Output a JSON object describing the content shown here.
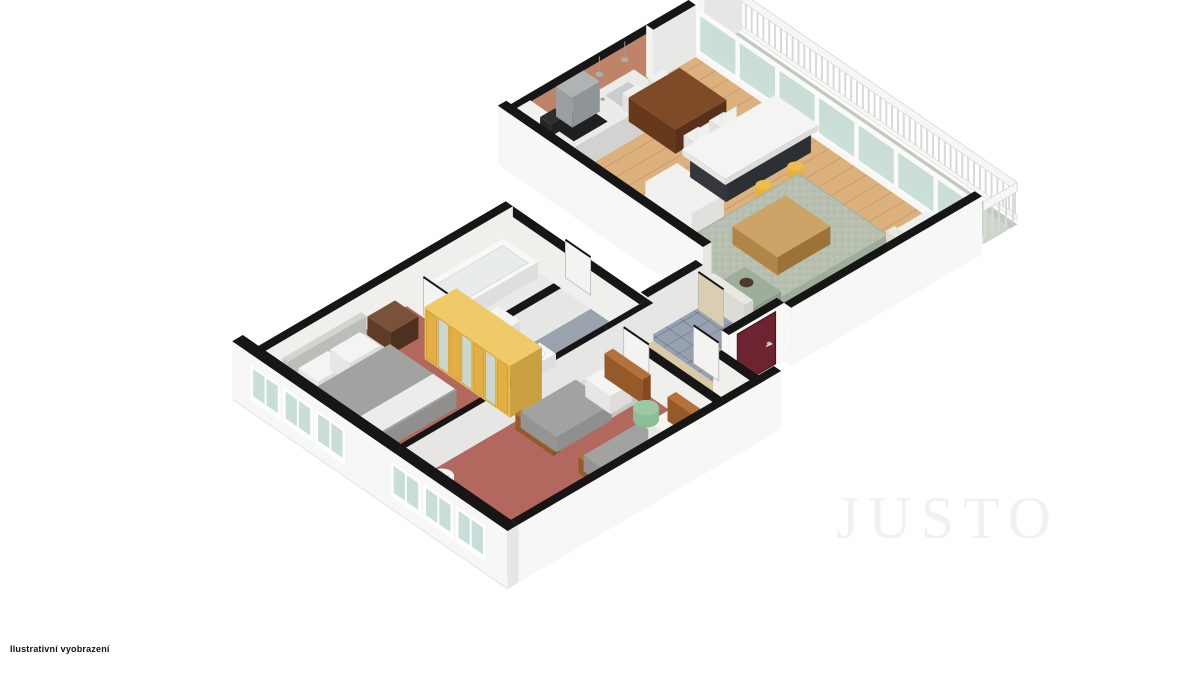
{
  "page": {
    "background": "#ffffff",
    "width": 1200,
    "height": 675
  },
  "watermark": {
    "text": "JUSTO",
    "color": "#f1f1f1"
  },
  "disclaimer": {
    "text": "Ilustrativní vyobrazení",
    "color": "#141414"
  },
  "plan": {
    "type": "3d-floorplan",
    "style": "isometric dollhouse cutaway, white background, black wall caps",
    "rooms": [
      {
        "id": "bedroom-main",
        "floor": "#b2685e"
      },
      {
        "id": "bedroom-second",
        "floor": "#b2685e"
      },
      {
        "id": "bathroom",
        "floor": "#e9e9e6"
      },
      {
        "id": "wc",
        "floor": "#9aa2ad"
      },
      {
        "id": "hallway",
        "floor": "#d9c9a8"
      },
      {
        "id": "entry-hall",
        "floor": "#98a1b0"
      },
      {
        "id": "kitchen",
        "floor": "#ddb17e"
      },
      {
        "id": "living-room",
        "floor": "#ddb17e"
      },
      {
        "id": "balcony",
        "floor": "#cdd4c9"
      }
    ],
    "furniture": [
      "double-bed",
      "nightstand",
      "wardrobe",
      "single-bed",
      "single-bed",
      "pouf",
      "bedside-lamp-table",
      "bathtub",
      "washbasin",
      "toilet",
      "kitchen-counter",
      "range-hood",
      "tall-cabinet",
      "hall-closet",
      "kitchen-island",
      "bar-stool",
      "bar-stool",
      "dining-table",
      "dining-chair",
      "dining-chair",
      "dining-chair",
      "dining-chair",
      "sofa",
      "armchair",
      "chaise-lounge",
      "coffee-table",
      "area-rug",
      "entrance-door",
      "interior-doors",
      "balcony-railing"
    ],
    "colors": {
      "wallCap": "#161616",
      "wallFaceFront": "#f7f7f5",
      "wallFaceSide": "#e6e6e4",
      "wallFaceInner": "#efefec",
      "wood": "#ddb17e",
      "woodLine": "rgba(150,105,55,0.28)",
      "carpet": "#b2685e",
      "carpetEdge": "#a05a50",
      "tile": "#98a1b0",
      "tileLine": "rgba(60,70,95,0.35)",
      "bathFloor": "#e9e9e6",
      "wcFloor": "#9aa2ad",
      "hallFloor": "#d9c9a8",
      "balconyFloor": "#cdd4c9",
      "balconyEdge": "#c2c9be",
      "railing": "#f6f6f4",
      "railingShade": "#d9d9d5",
      "glass": "#c9ded8",
      "frame": "#fafaf8",
      "terracotta": "#bf8467",
      "terracottaEnd": "#caa58c",
      "islandBase": "#46494e",
      "islandBaseSide": "#34373c",
      "islandTop": "#f4f4f2",
      "stool": "#e5b13c",
      "stoolTop": "#edbd4e",
      "tableWood": "#7e4a28",
      "tableWoodSide": "#66391d",
      "chair": "#f0f0ee",
      "sofaBase": "#e9e9e4",
      "sofaPattern": "#9fae9b",
      "sofaPatternDark": "#8c9b88",
      "pillowBrown": "#4c3a2a",
      "rugBase": "#b7c0b0",
      "rugEdge": "#a8b2a2",
      "coffeeTop": "#cda467",
      "coffeeSide": "#b08648",
      "blanket": "#a2a2a0",
      "blanketSide": "#8f8f8d",
      "sheet": "#f4f4f2",
      "mattress": "#d9d9d7",
      "headboardGray": "#d3d3d0",
      "wardrobe": "#e8ba4e",
      "wardrobeTop": "#f0c968",
      "wardrobeSide": "#c99f3f",
      "wardrobeStripe": "#e3ae42",
      "mirror": "#ccd6d1",
      "nightstand": "#7a523a",
      "nightstandSide": "#5e3c28",
      "bedWood": "#b5713c",
      "bedWoodSide": "#96592a",
      "pouf": "#8cbd96",
      "poufTop": "#9cc8a4",
      "lamp": "#ededeb",
      "lampTop": "#f6f6f4",
      "doorWhite": "#f4f3f1",
      "doorBeige": "#d9cdb4",
      "entranceDoor": "#6e2430",
      "entranceDoorEdge": "#49161f",
      "hood": "#aeb3b4",
      "hoodSide": "#9aa0a1",
      "counterTop": "#ebebe9",
      "counterFace": "#dededc",
      "cooktop": "#1f1f21",
      "sinkSteel": "#c9cdce",
      "cabinetWhite": "#f1f1ef",
      "cabinetSide": "#e0e0de",
      "shaft": "#333335",
      "tub": "#f8f8f6",
      "tubInner": "#e9ecec"
    }
  }
}
